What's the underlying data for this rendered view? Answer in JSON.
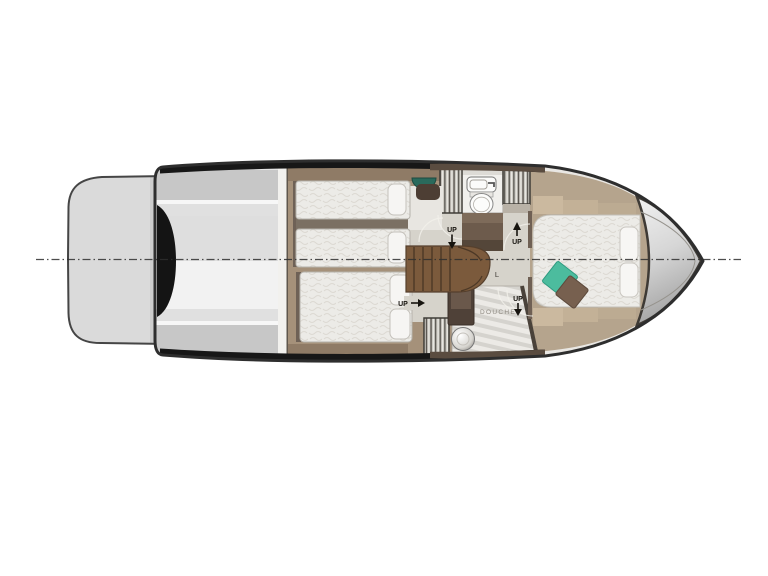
{
  "plan": {
    "title": "Motor yacht lower deck floor plan",
    "labels": {
      "up": "UP",
      "shower_room": "DOUCHE",
      "locker_mark": "L"
    },
    "rooms": [
      "swim-platform",
      "cockpit-engine-room",
      "twin-guest-cabin",
      "double-guest-cabin",
      "staircase",
      "head-toilet",
      "shower-room",
      "master-cabin",
      "bow-deck"
    ],
    "markers": [
      {
        "label": "UP",
        "direction": "down",
        "location": "head-entry"
      },
      {
        "label": "UP",
        "direction": "up",
        "location": "master-entry"
      },
      {
        "label": "UP",
        "direction": "right",
        "location": "double-cabin-entry"
      },
      {
        "label": "UP",
        "direction": "down",
        "location": "shower-entry"
      }
    ],
    "colors": {
      "hull_outline": "#2e2e2e",
      "platform": "#dadada",
      "aft_floor": "#a5917a",
      "master_floor": "#b5a48d",
      "corridor_floor": "#d6d3cb",
      "stairs": "#7b5a3c",
      "mattress": "#ecebe7",
      "teal_pillow": "#4cbc9e",
      "brown_pillow": "#77604f",
      "centerline": "#2f2f2f"
    }
  }
}
